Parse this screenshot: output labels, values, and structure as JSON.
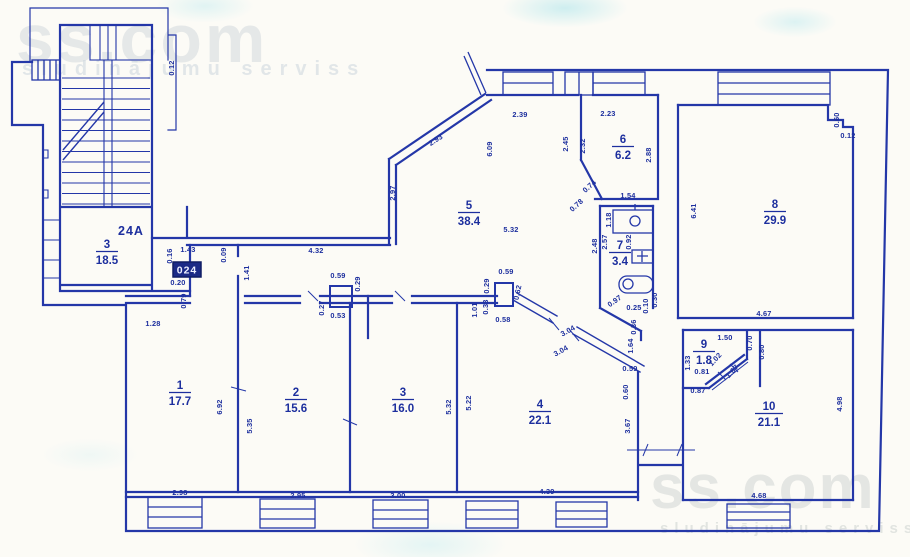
{
  "watermarks": {
    "brand": "ss.com",
    "tagline": "sludinājumu serviss"
  },
  "plan": {
    "building_label": "24A",
    "unit_badge": "024",
    "rooms": [
      {
        "number": "3",
        "area": "18.5",
        "x": 107,
        "y": 248
      },
      {
        "number": "1",
        "area": "17.7",
        "x": 180,
        "y": 389
      },
      {
        "number": "2",
        "area": "15.6",
        "x": 296,
        "y": 396
      },
      {
        "number": "3",
        "area": "16.0",
        "x": 403,
        "y": 396
      },
      {
        "number": "4",
        "area": "22.1",
        "x": 540,
        "y": 408
      },
      {
        "number": "5",
        "area": "38.4",
        "x": 469,
        "y": 209
      },
      {
        "number": "6",
        "area": "6.2",
        "x": 623,
        "y": 143
      },
      {
        "number": "7",
        "area": "3.4",
        "x": 620,
        "y": 249
      },
      {
        "number": "8",
        "area": "29.9",
        "x": 775,
        "y": 208
      },
      {
        "number": "9",
        "area": "1.8",
        "x": 704,
        "y": 348
      },
      {
        "number": "10",
        "area": "21.1",
        "x": 769,
        "y": 410
      }
    ],
    "dimensions": [
      {
        "v": "0.12",
        "x": 174,
        "y": 68,
        "r": -90
      },
      {
        "v": "1.43",
        "x": 188,
        "y": 252,
        "r": 0
      },
      {
        "v": "0.16",
        "x": 172,
        "y": 256,
        "r": -90
      },
      {
        "v": "0.20",
        "x": 178,
        "y": 285,
        "r": 0
      },
      {
        "v": "0.79",
        "x": 186,
        "y": 301,
        "r": -90
      },
      {
        "v": "0.09",
        "x": 226,
        "y": 255,
        "r": -90
      },
      {
        "v": "1.41",
        "x": 249,
        "y": 273,
        "r": -90
      },
      {
        "v": "4.32",
        "x": 316,
        "y": 253,
        "r": 0
      },
      {
        "v": "1.28",
        "x": 153,
        "y": 326,
        "r": 0
      },
      {
        "v": "2.93",
        "x": 437,
        "y": 142,
        "r": -33
      },
      {
        "v": "2.97",
        "x": 395,
        "y": 193,
        "r": -90
      },
      {
        "v": "2.39",
        "x": 520,
        "y": 117,
        "r": 0
      },
      {
        "v": "6.09",
        "x": 492,
        "y": 149,
        "r": -90
      },
      {
        "v": "5.32",
        "x": 511,
        "y": 232,
        "r": 0
      },
      {
        "v": "2.45",
        "x": 568,
        "y": 144,
        "r": -90
      },
      {
        "v": "2.32",
        "x": 585,
        "y": 146,
        "r": -90
      },
      {
        "v": "2.23",
        "x": 608,
        "y": 116,
        "r": 0
      },
      {
        "v": "2.88",
        "x": 651,
        "y": 155,
        "r": -90
      },
      {
        "v": "1.54",
        "x": 628,
        "y": 198,
        "r": 0
      },
      {
        "v": "0.74",
        "x": 591,
        "y": 188,
        "r": -42
      },
      {
        "v": "0.78",
        "x": 578,
        "y": 207,
        "r": -42
      },
      {
        "v": "1.18",
        "x": 611,
        "y": 220,
        "r": -90
      },
      {
        "v": "2.57",
        "x": 607,
        "y": 242,
        "r": -90
      },
      {
        "v": "2.48",
        "x": 597,
        "y": 246,
        "r": -90
      },
      {
        "v": "0.92",
        "x": 631,
        "y": 242,
        "r": -90
      },
      {
        "v": "0.97",
        "x": 616,
        "y": 303,
        "r": -35
      },
      {
        "v": "0.25",
        "x": 634,
        "y": 310,
        "r": 0
      },
      {
        "v": "0.10",
        "x": 648,
        "y": 306,
        "r": -90
      },
      {
        "v": "0.30",
        "x": 657,
        "y": 300,
        "r": -90
      },
      {
        "v": "0.36",
        "x": 636,
        "y": 327,
        "r": -90
      },
      {
        "v": "1.64",
        "x": 633,
        "y": 346,
        "r": -90
      },
      {
        "v": "0.59",
        "x": 630,
        "y": 371,
        "r": 0
      },
      {
        "v": "0.60",
        "x": 628,
        "y": 392,
        "r": -90
      },
      {
        "v": "3.67",
        "x": 630,
        "y": 426,
        "r": -90
      },
      {
        "v": "6.41",
        "x": 696,
        "y": 211,
        "r": -90
      },
      {
        "v": "4.67",
        "x": 764,
        "y": 316,
        "r": 0
      },
      {
        "v": "0.60",
        "x": 839,
        "y": 120,
        "r": -90
      },
      {
        "v": "0.12",
        "x": 848,
        "y": 138,
        "r": 0
      },
      {
        "v": "1.50",
        "x": 725,
        "y": 340,
        "r": 0
      },
      {
        "v": "0.70",
        "x": 752,
        "y": 343,
        "r": -90
      },
      {
        "v": "0.80",
        "x": 764,
        "y": 352,
        "r": -90
      },
      {
        "v": "1.33",
        "x": 690,
        "y": 363,
        "r": -90
      },
      {
        "v": "1.02",
        "x": 717,
        "y": 361,
        "r": -48
      },
      {
        "v": "1.67",
        "x": 734,
        "y": 373,
        "r": -48
      },
      {
        "v": "0.81",
        "x": 702,
        "y": 374,
        "r": 0
      },
      {
        "v": "0.87",
        "x": 698,
        "y": 393,
        "r": 0
      },
      {
        "v": "4.98",
        "x": 842,
        "y": 404,
        "r": -90
      },
      {
        "v": "4.68",
        "x": 759,
        "y": 498,
        "r": 0
      },
      {
        "v": "6.92",
        "x": 222,
        "y": 407,
        "r": -90
      },
      {
        "v": "2.98",
        "x": 180,
        "y": 495,
        "r": 0
      },
      {
        "v": "5.35",
        "x": 252,
        "y": 426,
        "r": -90
      },
      {
        "v": "2.95",
        "x": 298,
        "y": 498,
        "r": 0
      },
      {
        "v": "5.32",
        "x": 451,
        "y": 407,
        "r": -90
      },
      {
        "v": "3.00",
        "x": 398,
        "y": 498,
        "r": 0
      },
      {
        "v": "5.22",
        "x": 471,
        "y": 403,
        "r": -90
      },
      {
        "v": "4.39",
        "x": 547,
        "y": 494,
        "r": 0
      },
      {
        "v": "3.04",
        "x": 569,
        "y": 333,
        "r": -29
      },
      {
        "v": "3.04",
        "x": 562,
        "y": 353,
        "r": -29
      },
      {
        "v": "0.59",
        "x": 338,
        "y": 278,
        "r": 0
      },
      {
        "v": "0.29",
        "x": 360,
        "y": 284,
        "r": -90
      },
      {
        "v": "0.27",
        "x": 324,
        "y": 308,
        "r": -90
      },
      {
        "v": "0.53",
        "x": 338,
        "y": 318,
        "r": 0
      },
      {
        "v": "0.59",
        "x": 506,
        "y": 274,
        "r": 0
      },
      {
        "v": "0.29",
        "x": 489,
        "y": 286,
        "r": -90
      },
      {
        "v": "0.62",
        "x": 520,
        "y": 293,
        "r": -78
      },
      {
        "v": "1.01",
        "x": 477,
        "y": 310,
        "r": -90
      },
      {
        "v": "0.33",
        "x": 488,
        "y": 307,
        "r": -90
      },
      {
        "v": "0.58",
        "x": 503,
        "y": 322,
        "r": 0
      }
    ]
  }
}
